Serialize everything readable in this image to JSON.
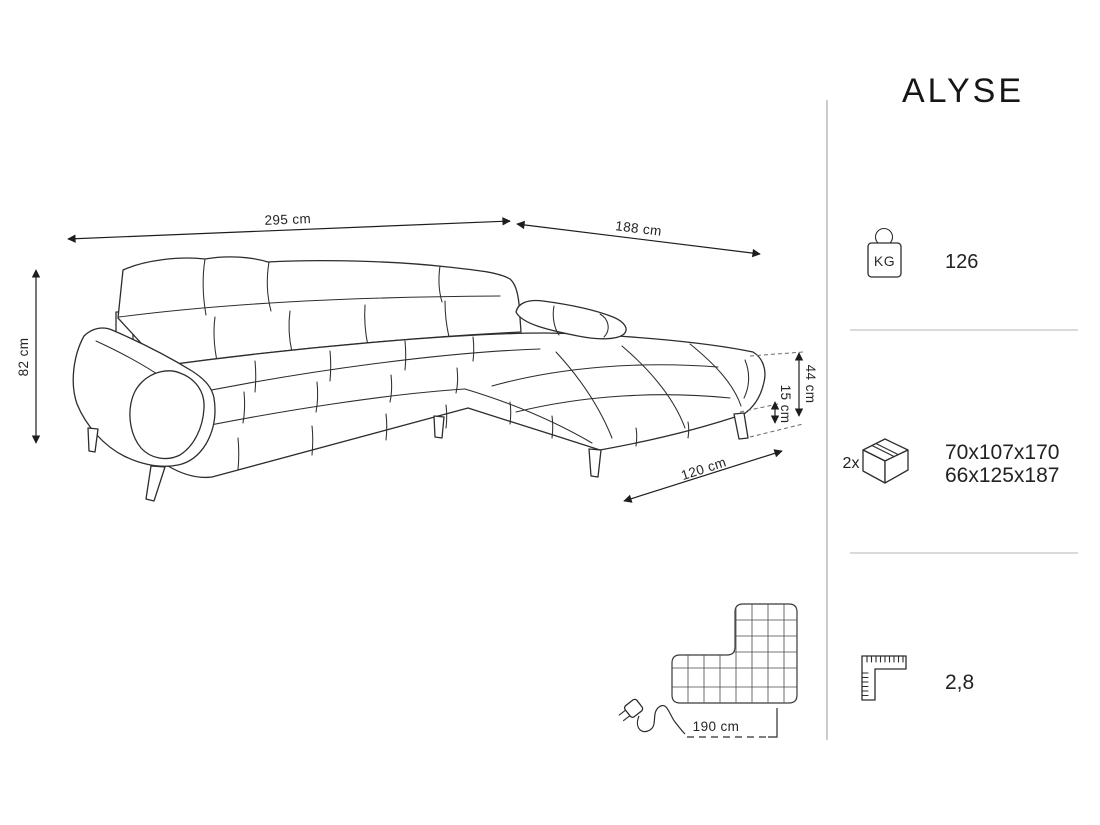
{
  "product": {
    "name": "ALYSE"
  },
  "dimensions": {
    "width": "295 cm",
    "depth": "188 cm",
    "height": "82 cm",
    "seat_height": "44 cm",
    "leg_height": "15 cm",
    "chaise_depth": "120 cm",
    "cable_length": "190 cm"
  },
  "specs": {
    "weight": {
      "badge": "KG",
      "value": "126"
    },
    "package": {
      "count": "2x",
      "line1": "70x107x170",
      "line2": "66x125x187"
    },
    "volume": {
      "value": "2,8"
    }
  },
  "colors": {
    "line": "#2d2d2d",
    "text": "#222222",
    "divider": "#b5b5b5",
    "background": "#ffffff"
  }
}
